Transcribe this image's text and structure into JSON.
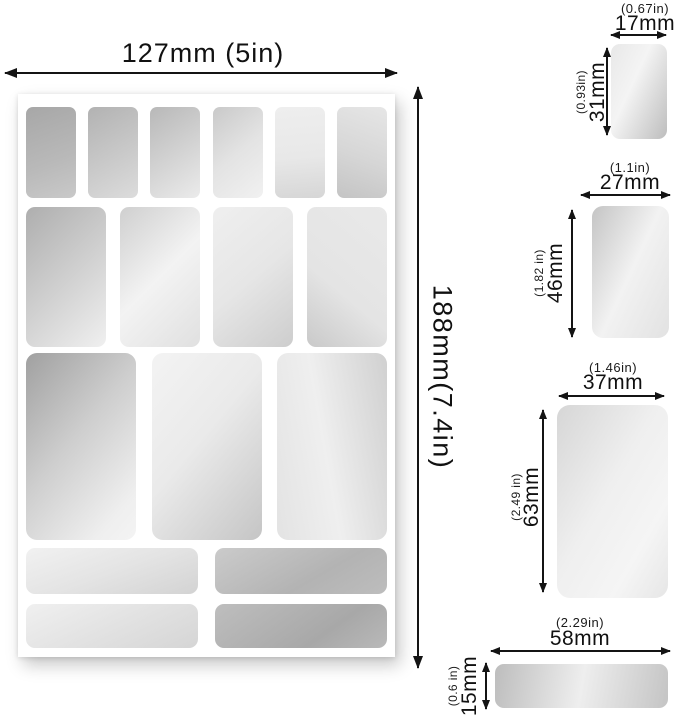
{
  "sheet": {
    "width_label": "127mm (5in)",
    "height_label": "188mm(7.4in)",
    "rows": [
      {
        "pieces": 6,
        "size": "17x31mm"
      },
      {
        "pieces": 4,
        "size": "27x46mm"
      },
      {
        "pieces": 3,
        "size": "37x63mm"
      },
      {
        "pieces": 2,
        "size": "58x15mm"
      },
      {
        "pieces": 2,
        "size": "58x15mm"
      }
    ]
  },
  "samples": [
    {
      "name": "sticker-17x31mm",
      "width_mm": "17mm",
      "width_in": "(0.67in)",
      "height_mm": "31mm",
      "height_in": "(0.93in)"
    },
    {
      "name": "sticker-27x46mm",
      "width_mm": "27mm",
      "width_in": "(1.1in)",
      "height_mm": "46mm",
      "height_in": "(1.82 in)"
    },
    {
      "name": "sticker-37x63mm",
      "width_mm": "37mm",
      "width_in": "(1.46in)",
      "height_mm": "63mm",
      "height_in": "(2.49 in)"
    },
    {
      "name": "sticker-58x15mm",
      "width_mm": "58mm",
      "width_in": "(2.29in)",
      "height_mm": "15mm",
      "height_in": "(0.6 in)"
    }
  ],
  "colors": {
    "text": "#111111",
    "arrow": "#141414",
    "background": "#ffffff",
    "mirror_light": "#f2f2f2",
    "mirror_dark": "#a6a6a6"
  }
}
